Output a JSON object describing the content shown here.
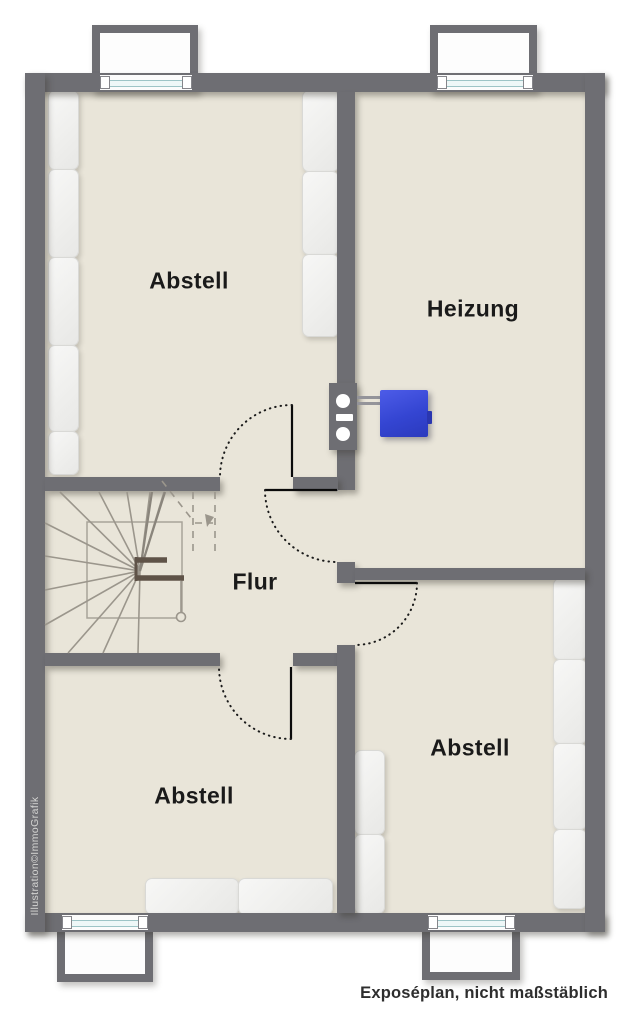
{
  "plan": {
    "caption": "Exposéplan, nicht maßstäblich",
    "watermark": "Illustration©ImmoGrafik",
    "rooms": [
      {
        "id": "abstell-top-left",
        "label": "Abstell"
      },
      {
        "id": "heizung",
        "label": "Heizung"
      },
      {
        "id": "flur",
        "label": "Flur"
      },
      {
        "id": "abstell-bottom-left",
        "label": "Abstell"
      },
      {
        "id": "abstell-bottom-right",
        "label": "Abstell"
      }
    ],
    "colors": {
      "wall": "#6e6e73",
      "floor": "#e9e5d9",
      "boiler_blue": "#3445d2",
      "window_glass": "#9dc4c6",
      "radiator": "#f3f3f2",
      "background": "#ffffff"
    }
  }
}
